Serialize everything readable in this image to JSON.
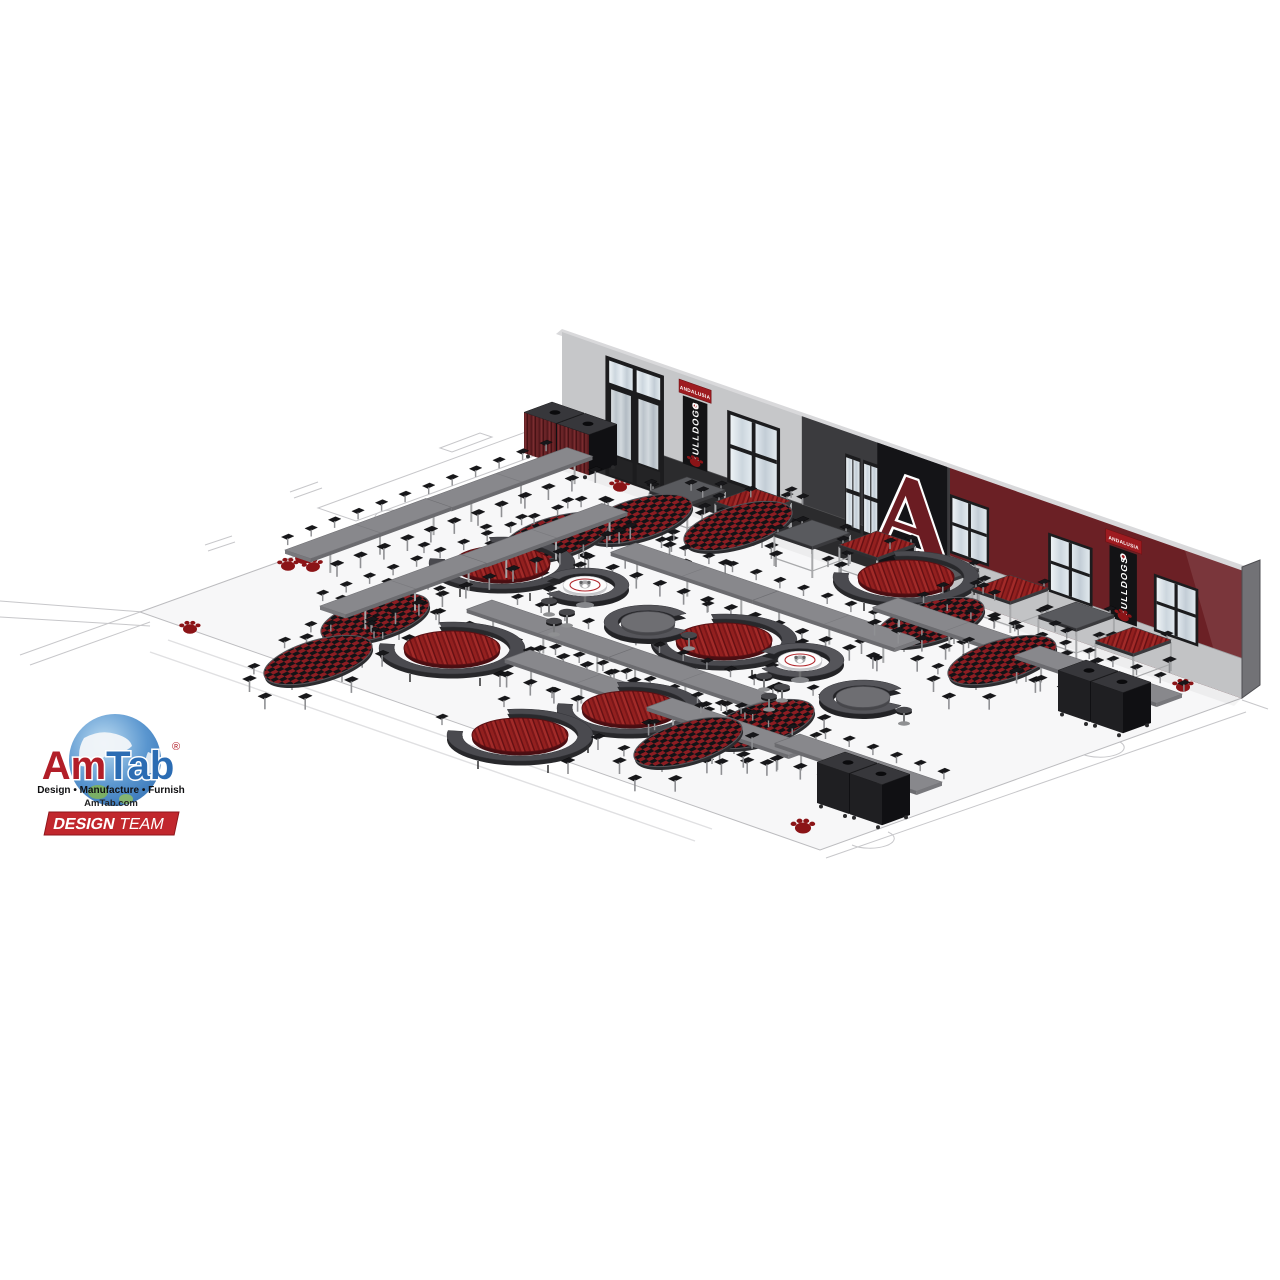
{
  "meta": {
    "description": "3D rendering of a school cafeteria furniture layout design"
  },
  "colors": {
    "amRed": "#b21e28",
    "tabBlue": "#2b6cb3",
    "badgeRed": "#c1272d",
    "maroon": "#6b2025",
    "wallLight": "#c6c7c9",
    "wallDark": "#3b3b3e",
    "wainscotDark": "#2b2b2d",
    "panelBlack": "#141417",
    "bannerRed": "#9e1b20",
    "bannerBlack": "#131315",
    "tableGray": "#88888c",
    "stoolBlack": "#17171a",
    "checkerRed": "#8c1d22",
    "woodRed": "#8e1b1e",
    "floor": "#f7f7f8",
    "pawRed": "#8b1417",
    "letterMaroon": "#6b1c22"
  },
  "branding": {
    "logo": {
      "am": "Am",
      "tab": "Tab",
      "reg": "®",
      "tagline": "Design • Manufacture • Furnish",
      "website": "AmTab.com"
    },
    "badge": {
      "design": "DESIGN",
      "team": "TEAM"
    }
  },
  "wall": {
    "letter": "A",
    "banner": {
      "school": "ANDALUSIA",
      "team": "BULLDOGS"
    }
  },
  "scene": {
    "furniture": [
      {
        "type": "bench-table",
        "label": "Mobile convertible bench tables with attached stools",
        "count": 13
      },
      {
        "type": "oval-stool-table",
        "label": "Oval tables with plaid tops and attached stools",
        "count": 9
      },
      {
        "type": "round-stool-table",
        "label": "Round wood-top tables with curved bench ring",
        "count": 6
      },
      {
        "type": "serpentine-booth",
        "label": "Serpentine booth clusters with logo cafe tables",
        "count": 2
      },
      {
        "type": "standing-table",
        "label": "Standing-height stool tables along wall",
        "count": 8
      },
      {
        "type": "waste-receptacle",
        "label": "Waste receptacle cabinets",
        "count": 6
      },
      {
        "type": "paw-decal",
        "label": "Paw print floor decals",
        "count": 8
      }
    ]
  }
}
